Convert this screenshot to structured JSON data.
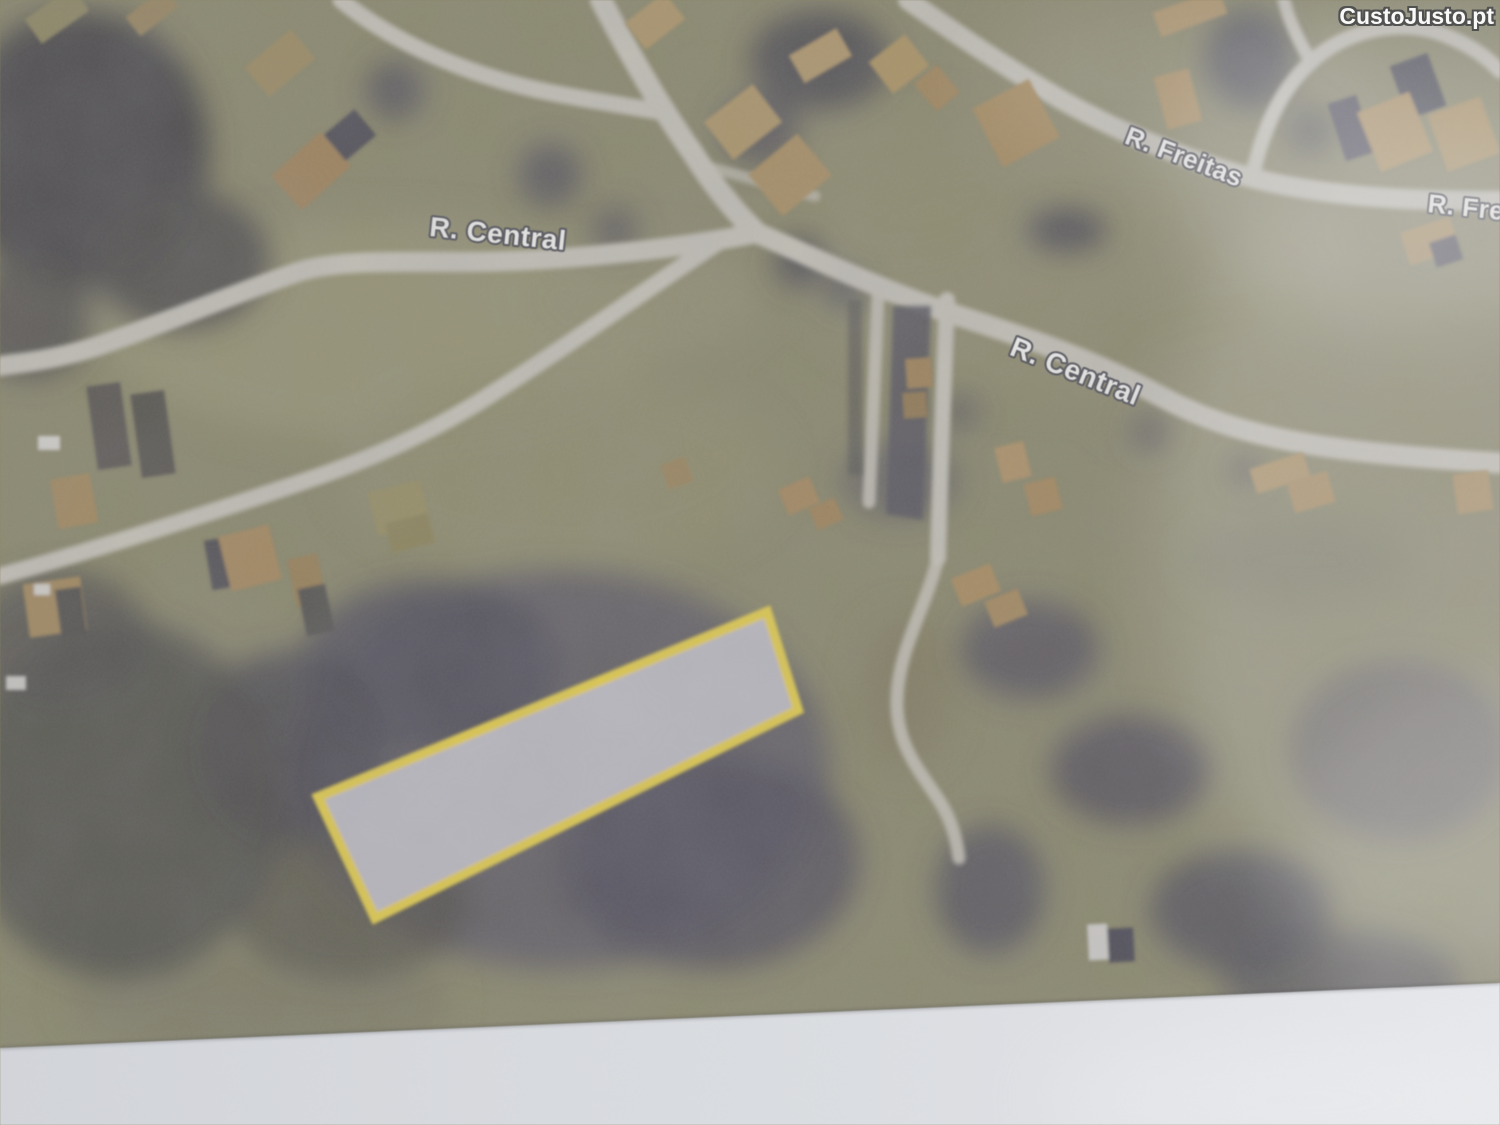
{
  "watermark": {
    "text": "CustoJusto.pt"
  },
  "map": {
    "street_labels": [
      {
        "id": "r-central-west",
        "text": "R. Central"
      },
      {
        "id": "r-freitas",
        "text": "R. Freitas"
      },
      {
        "id": "r-freitas-right",
        "text": "R. Fre"
      },
      {
        "id": "r-central-east",
        "text": "R. Central"
      }
    ],
    "highlighted_plot": {
      "outline_color": "#f0d326",
      "fill_color": "#c1bfc7",
      "corners": [
        [
          767,
          612
        ],
        [
          798,
          710
        ],
        [
          375,
          918
        ],
        [
          318,
          797
        ]
      ]
    },
    "colors": {
      "road": "#c6c2b4",
      "field_olive": "#8b8862",
      "dark_vegetation": "#53505a",
      "roof_tan": "#b18c52",
      "plot_yellow": "#f0d326",
      "page_margin": "#dfe2e8",
      "watermark_text": "#fdfdfd",
      "watermark_outline": "#4f4f4f"
    }
  }
}
